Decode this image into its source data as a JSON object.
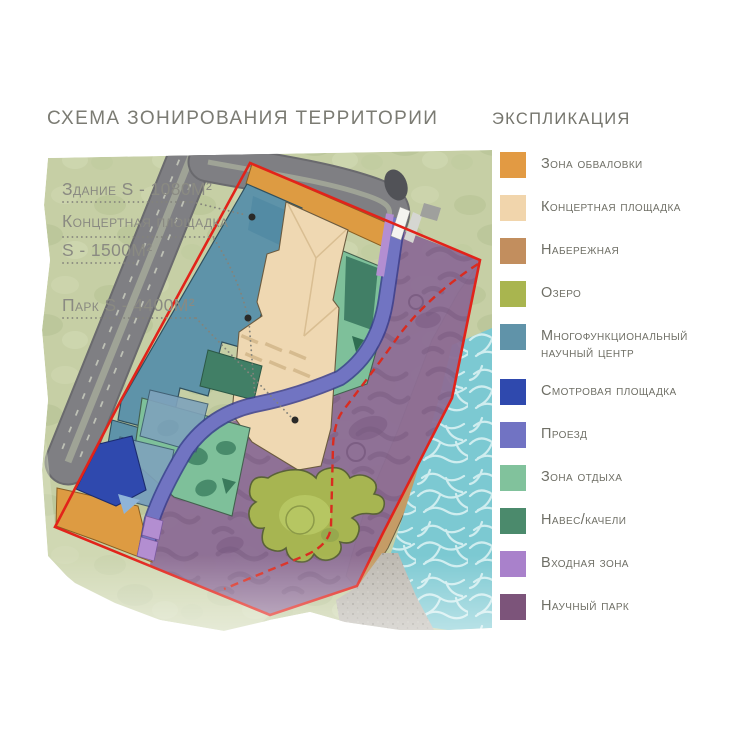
{
  "title": "СХЕМА ЗОНИРОВАНИЯ ТЕРРИТОРИИ",
  "legend": {
    "title": "ЭКСПЛИКАЦИЯ",
    "items": [
      {
        "label": "Зона обваловки",
        "color": "#E29A43"
      },
      {
        "label": "Концертная площадка",
        "color": "#F1D5AC"
      },
      {
        "label": "Набережная",
        "color": "#C28E5E"
      },
      {
        "label": "Озеро",
        "color": "#A9B54F"
      },
      {
        "label": "Многофункциональный научный центр",
        "color": "#6093A9"
      },
      {
        "label": "Смотровая площадка",
        "color": "#2F49AE"
      },
      {
        "label": "Проезд",
        "color": "#7173C3"
      },
      {
        "label": "Зона отдыха",
        "color": "#81C29C"
      },
      {
        "label": "Навес/качели",
        "color": "#4B8A6C"
      },
      {
        "label": "Входная зона",
        "color": "#A981CB"
      },
      {
        "label": "Научный парк",
        "color": "#7C547A"
      }
    ]
  },
  "annotations": {
    "building": "Здание S - 1080М²",
    "concert_line1": "Концертная площадка",
    "concert_line2": "S - 1500М²",
    "park": "Парк S - 4400М²"
  },
  "map": {
    "boundary_color": "#E2231A",
    "background_color": "#C6CFA5",
    "water_color": "#7CC9D2",
    "road_color": "#7F7F83",
    "science_park_color": "#8C6D95"
  }
}
